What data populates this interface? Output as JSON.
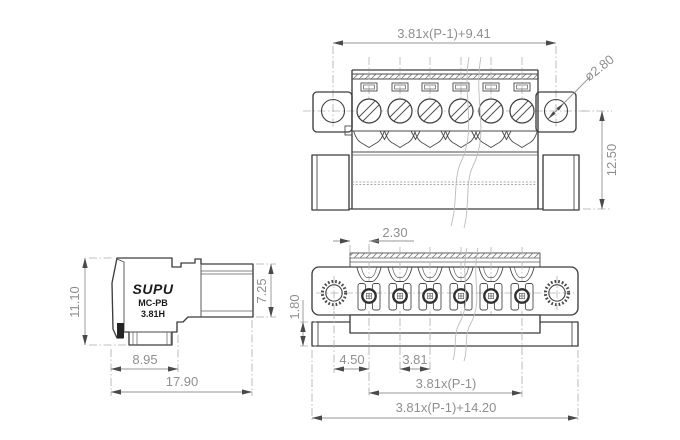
{
  "views": {
    "front": {
      "dim_pitch_total": "3.81x(P-1)+9.41",
      "dim_hole_diameter": "ø2.80",
      "dim_height": "12.50"
    },
    "side": {
      "brand": "SUPU",
      "series": "MC-PB",
      "model": "3.81H",
      "dim_height": "11.10",
      "dim_plug_height": "7.25",
      "dim_base_depth": "8.95",
      "dim_total_depth": "17.90"
    },
    "top": {
      "dim_edge_offset": "2.30",
      "dim_base_thickness": "1.80",
      "dim_end_margin": "4.50",
      "dim_pitch": "3.81",
      "dim_pitch_span": "3.81x(P-1)",
      "dim_total_width": "3.81x(P-1)+14.20"
    }
  },
  "colors": {
    "outline": "#3d3d3d",
    "dimension": "#8f8f8f",
    "background": "#ffffff"
  }
}
